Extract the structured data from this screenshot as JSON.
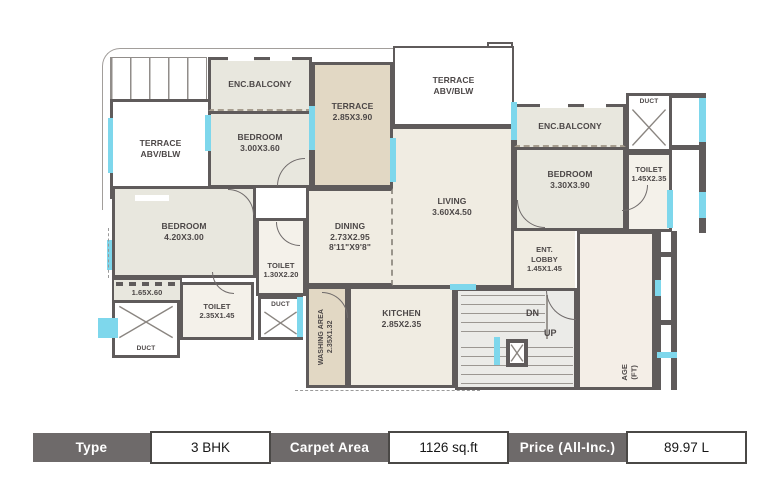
{
  "plan": {
    "rooms": [
      {
        "id": "terrace-left",
        "label": "TERRACE",
        "sub": "ABV/BLW"
      },
      {
        "id": "enc-balcony-top",
        "label": "ENC.BALCONY"
      },
      {
        "id": "bedroom-top",
        "label": "BEDROOM",
        "sub": "3.00X3.60"
      },
      {
        "id": "terrace-mid",
        "label": "TERRACE",
        "sub": "2.85X3.90"
      },
      {
        "id": "terrace-top",
        "label": "TERRACE",
        "sub": "ABV/BLW"
      },
      {
        "id": "living",
        "label": "LIVING",
        "sub": "3.60X4.50"
      },
      {
        "id": "enc-balcony-right",
        "label": "ENC.BALCONY"
      },
      {
        "id": "bedroom-right",
        "label": "BEDROOM",
        "sub": "3.30X3.90"
      },
      {
        "id": "duct-top-right",
        "label": "DUCT"
      },
      {
        "id": "toilet-right",
        "label": "TOILET",
        "sub": "1.45X2.35"
      },
      {
        "id": "bedroom-left",
        "label": "BEDROOM",
        "sub": "4.20X3.00"
      },
      {
        "id": "toilet-mid",
        "label": "TOILET",
        "sub": "1.30X2.20"
      },
      {
        "id": "dining",
        "label": "DINING",
        "sub": "2.73X2.95",
        "sub2": "8'11\"X9'8\""
      },
      {
        "id": "balcony-strip",
        "label": "1.65X.60"
      },
      {
        "id": "duct-left",
        "label": "DUCT"
      },
      {
        "id": "toilet-left",
        "label": "TOILET",
        "sub": "2.35X1.45"
      },
      {
        "id": "duct-mid",
        "label": "DUCT"
      },
      {
        "id": "washing-area",
        "label": "WASHING AREA",
        "sub": "2.35X1.32"
      },
      {
        "id": "kitchen",
        "label": "KITCHEN",
        "sub": "2.85X2.35"
      },
      {
        "id": "ent-lobby",
        "label": "ENT.",
        "sub": "LOBBY",
        "sub2": "1.45X1.45"
      },
      {
        "id": "stairs-down",
        "label": "DN"
      },
      {
        "id": "stairs-up",
        "label": "UP"
      },
      {
        "id": "passage",
        "label": "AGE",
        "sub": "(FT)"
      }
    ]
  },
  "info_table": {
    "cells": [
      {
        "label": "Type",
        "value": "3 BHK"
      },
      {
        "label": "Carpet Area",
        "value": "1126 sq.ft"
      },
      {
        "label": "Price (All-Inc.)",
        "value": "89.97 L"
      }
    ]
  },
  "colors": {
    "wall": "#5f5b5b",
    "window": "#7ed7ec",
    "ink": "#4c4747",
    "room-white": "#ffffff",
    "sage": "#e8e7de",
    "tan": "#e2d8c4",
    "cream": "#f0ece2",
    "cream2": "#f4eee7",
    "toilet": "#f4f1ea",
    "stair": "#ebebe8",
    "dark-cell": "#6e6a6a"
  }
}
